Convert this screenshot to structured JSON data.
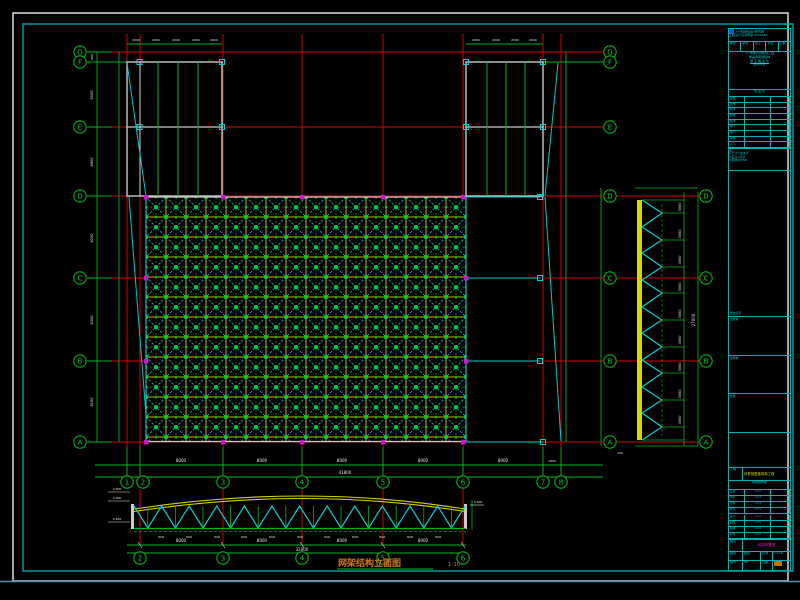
{
  "colors": {
    "red": "#d40000",
    "green": "#00b41e",
    "node_green": "#00d23c",
    "cyan": "#00c8c8",
    "frame_cyan": "#00b2b2",
    "yellow": "#cfcf00",
    "gray": "#c8c8c8",
    "magenta": "#cc18cc",
    "orange": "#d07818",
    "white": "#e6e6e6"
  },
  "plan": {
    "row_bubbles": [
      "G",
      "F",
      "E",
      "D",
      "C",
      "B",
      "A"
    ],
    "col_bubbles": [
      "1",
      "2",
      "3",
      "4",
      "5",
      "6",
      "7",
      "8"
    ],
    "bottom_overall": "41800"
  },
  "elevation_right": {
    "bubbles": [
      "D",
      "C",
      "B",
      "A"
    ],
    "panel_dim": "3000",
    "overall": "27000"
  },
  "truss": {
    "bottom_bubbles": [
      "2",
      "3",
      "4",
      "5",
      "6"
    ],
    "panel_dim": "3000",
    "span_dim": "8000",
    "overall": "32000",
    "title": "网架结构立面图",
    "scale": "1:10",
    "levels": [
      "4.500",
      "4.000",
      "0.450",
      "4.500"
    ]
  },
  "bubbles": [
    {
      "x": 80,
      "y": 52,
      "l": "G"
    },
    {
      "x": 80,
      "y": 62,
      "l": "F"
    },
    {
      "x": 80,
      "y": 127,
      "l": "E"
    },
    {
      "x": 80,
      "y": 196,
      "l": "D"
    },
    {
      "x": 80,
      "y": 278,
      "l": "C"
    },
    {
      "x": 80,
      "y": 361,
      "l": "B"
    },
    {
      "x": 80,
      "y": 442,
      "l": "A"
    },
    {
      "x": 610,
      "y": 52,
      "l": "G"
    },
    {
      "x": 610,
      "y": 62,
      "l": "F"
    },
    {
      "x": 610,
      "y": 127,
      "l": "E"
    },
    {
      "x": 610,
      "y": 196,
      "l": "D"
    },
    {
      "x": 610,
      "y": 278,
      "l": "C"
    },
    {
      "x": 610,
      "y": 361,
      "l": "B"
    },
    {
      "x": 610,
      "y": 442,
      "l": "A"
    },
    {
      "x": 706,
      "y": 196,
      "l": "D"
    },
    {
      "x": 706,
      "y": 278,
      "l": "C"
    },
    {
      "x": 706,
      "y": 361,
      "l": "B"
    },
    {
      "x": 706,
      "y": 442,
      "l": "A"
    },
    {
      "x": 127,
      "y": 482,
      "l": "1"
    },
    {
      "x": 143,
      "y": 482,
      "l": "2"
    },
    {
      "x": 223,
      "y": 482,
      "l": "3"
    },
    {
      "x": 302,
      "y": 482,
      "l": "4"
    },
    {
      "x": 383,
      "y": 482,
      "l": "5"
    },
    {
      "x": 463,
      "y": 482,
      "l": "6"
    },
    {
      "x": 543,
      "y": 482,
      "l": "7"
    },
    {
      "x": 561,
      "y": 482,
      "l": "8"
    },
    {
      "x": 140,
      "y": 558,
      "l": "2"
    },
    {
      "x": 223,
      "y": 558,
      "l": "3"
    },
    {
      "x": 302,
      "y": 558,
      "l": "4"
    },
    {
      "x": 383,
      "y": 558,
      "l": "5"
    },
    {
      "x": 463,
      "y": 558,
      "l": "6"
    }
  ],
  "dim_texts": [
    {
      "x": 136,
      "y": 41,
      "t": "2000",
      "s": 3
    },
    {
      "x": 156,
      "y": 41,
      "t": "2000",
      "s": 3
    },
    {
      "x": 176,
      "y": 41,
      "t": "2000",
      "s": 3
    },
    {
      "x": 196,
      "y": 41,
      "t": "2000",
      "s": 3
    },
    {
      "x": 214,
      "y": 41,
      "t": "2000",
      "s": 3
    },
    {
      "x": 476,
      "y": 41,
      "t": "2000",
      "s": 3
    },
    {
      "x": 496,
      "y": 41,
      "t": "2000",
      "s": 3
    },
    {
      "x": 515,
      "y": 41,
      "t": "2000",
      "s": 3
    },
    {
      "x": 533,
      "y": 41,
      "t": "2000",
      "s": 3
    },
    {
      "x": 93,
      "y": 57,
      "t": "900",
      "s": 3,
      "r": 1
    },
    {
      "x": 93,
      "y": 95,
      "t": "6500",
      "s": 3.5,
      "r": 1
    },
    {
      "x": 93,
      "y": 162,
      "t": "6900",
      "s": 3.5,
      "r": 1
    },
    {
      "x": 93,
      "y": 238,
      "t": "8250",
      "s": 3.5,
      "r": 1
    },
    {
      "x": 93,
      "y": 320,
      "t": "8300",
      "s": 3.5,
      "r": 1
    },
    {
      "x": 93,
      "y": 402,
      "t": "8100",
      "s": 3.5,
      "r": 1
    },
    {
      "x": 181,
      "y": 462,
      "t": "8000",
      "s": 4
    },
    {
      "x": 262,
      "y": 462,
      "t": "8000",
      "s": 4
    },
    {
      "x": 342,
      "y": 462,
      "t": "8000",
      "s": 4
    },
    {
      "x": 423,
      "y": 462,
      "t": "8000",
      "s": 4
    },
    {
      "x": 503,
      "y": 462,
      "t": "8000",
      "s": 4
    },
    {
      "x": 552,
      "y": 462,
      "t": "1800",
      "s": 3
    },
    {
      "x": 345,
      "y": 474,
      "t": "41800",
      "s": 4
    },
    {
      "x": 681,
      "y": 207,
      "t": "3000",
      "s": 3.5,
      "r": 1
    },
    {
      "x": 681,
      "y": 234,
      "t": "3000",
      "s": 3.5,
      "r": 1
    },
    {
      "x": 681,
      "y": 260,
      "t": "3000",
      "s": 3.5,
      "r": 1
    },
    {
      "x": 681,
      "y": 287,
      "t": "3000",
      "s": 3.5,
      "r": 1
    },
    {
      "x": 681,
      "y": 314,
      "t": "3000",
      "s": 3.5,
      "r": 1
    },
    {
      "x": 681,
      "y": 340,
      "t": "3000",
      "s": 3.5,
      "r": 1
    },
    {
      "x": 681,
      "y": 367,
      "t": "3000",
      "s": 3.5,
      "r": 1
    },
    {
      "x": 681,
      "y": 394,
      "t": "3000",
      "s": 3.5,
      "r": 1
    },
    {
      "x": 681,
      "y": 420,
      "t": "3000",
      "s": 3.5,
      "r": 1
    },
    {
      "x": 695,
      "y": 320,
      "t": "27000",
      "s": 4,
      "r": 1
    },
    {
      "x": 620,
      "y": 454,
      "t": "150",
      "s": 3
    },
    {
      "x": 117,
      "y": 490,
      "t": "4.500",
      "s": 3
    },
    {
      "x": 117,
      "y": 499,
      "t": "4.000",
      "s": 3
    },
    {
      "x": 117,
      "y": 520,
      "t": "0.450",
      "s": 3
    },
    {
      "x": 478,
      "y": 503,
      "t": "4.500",
      "s": 3
    },
    {
      "x": 161,
      "y": 538,
      "t": "3000",
      "s": 2.5
    },
    {
      "x": 189,
      "y": 538,
      "t": "3000",
      "s": 2.5
    },
    {
      "x": 217,
      "y": 538,
      "t": "3000",
      "s": 2.5
    },
    {
      "x": 244,
      "y": 538,
      "t": "3000",
      "s": 2.5
    },
    {
      "x": 272,
      "y": 538,
      "t": "3000",
      "s": 2.5
    },
    {
      "x": 300,
      "y": 538,
      "t": "3000",
      "s": 2.5
    },
    {
      "x": 327,
      "y": 538,
      "t": "3000",
      "s": 2.5
    },
    {
      "x": 355,
      "y": 538,
      "t": "3000",
      "s": 2.5
    },
    {
      "x": 382,
      "y": 538,
      "t": "3000",
      "s": 2.5
    },
    {
      "x": 410,
      "y": 538,
      "t": "3000",
      "s": 2.5
    },
    {
      "x": 438,
      "y": 538,
      "t": "3000",
      "s": 2.5
    },
    {
      "x": 181,
      "y": 542,
      "t": "8000",
      "s": 4
    },
    {
      "x": 262,
      "y": 542,
      "t": "8000",
      "s": 4
    },
    {
      "x": 342,
      "y": 542,
      "t": "8000",
      "s": 4
    },
    {
      "x": 423,
      "y": 542,
      "t": "8000",
      "s": 4
    },
    {
      "x": 302,
      "y": 551,
      "t": "32000",
      "s": 4
    }
  ],
  "title_block": {
    "company": "××省建筑设计研究院",
    "company_sub": "工程设计证书甲级 A123456",
    "approve_cells": [
      "审定",
      "审核",
      "总工",
      "专业",
      "日期"
    ],
    "project_lines": [
      "××市体育训练馆工程",
      "屋盖网架钢结构",
      "施 工 图 设 计",
      "结构专业"
    ],
    "sign_title": "会 签 栏",
    "sign_rows": [
      "建筑",
      "结构",
      "给水",
      "排水",
      "暖通",
      "电气",
      "动力",
      "总图",
      "工艺"
    ],
    "notes": [
      "注:",
      "1.尺寸以毫米计",
      "2.标高以米计",
      "3.钢材Q235B"
    ],
    "record_label": "修改记录",
    "box_labels": [
      "出图章",
      "注册章",
      "批准"
    ],
    "project_label": "工程",
    "project_value": "体育馆屋盖网架工程",
    "sub_title": "网架结构图",
    "staff_rows": [
      "设总",
      "审定",
      "审核",
      "校对",
      "设计",
      "制图",
      "描图",
      "复核"
    ],
    "staff_val": "×××",
    "title_label": "图名",
    "title_value": "网架布置图",
    "meta_a": "图别",
    "meta_av": "结施",
    "meta_b": "图号",
    "meta_bv": "08",
    "meta_c": "比例",
    "meta_cv": "1:100",
    "meta_d": "日期",
    "meta_dv": "2009.06"
  }
}
